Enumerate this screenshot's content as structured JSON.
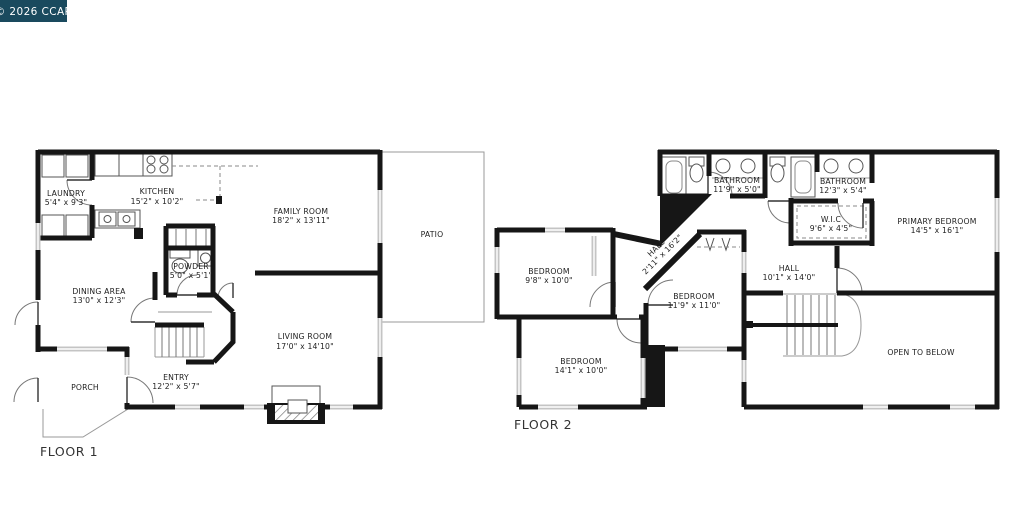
{
  "badge": {
    "label": "© 2026 CCAR"
  },
  "colors": {
    "badge_bg": "#1a4a5e",
    "wall": "#161616",
    "window": "#c4c4c4"
  },
  "floor1": {
    "label": "FLOOR 1",
    "rooms": {
      "laundry": {
        "name": "LAUNDRY",
        "dims": "5'4\" x 9'3\""
      },
      "kitchen": {
        "name": "KITCHEN",
        "dims": "15'2\" x 10'2\""
      },
      "family": {
        "name": "FAMILY ROOM",
        "dims": "18'2\" x 13'11\""
      },
      "patio": {
        "name": "PATIO"
      },
      "powder": {
        "name": "POWDER",
        "dims": "5'0\" x 5'1\""
      },
      "dining": {
        "name": "DINING AREA",
        "dims": "13'0\" x 12'3\""
      },
      "living": {
        "name": "LIVING ROOM",
        "dims": "17'0\" x 14'10\""
      },
      "entry": {
        "name": "ENTRY",
        "dims": "12'2\" x 5'7\""
      },
      "porch": {
        "name": "PORCH"
      }
    }
  },
  "floor2": {
    "label": "FLOOR 2",
    "rooms": {
      "bathroom1": {
        "name": "BATHROOM",
        "dims": "11'9\" x 5'0\""
      },
      "bathroom2": {
        "name": "BATHROOM",
        "dims": "12'3\" x 5'4\""
      },
      "wic": {
        "name": "W.I.C",
        "dims": "9'6\" x 4'5\""
      },
      "primary": {
        "name": "PRIMARY BEDROOM",
        "dims": "14'5\" x 16'1\""
      },
      "bedroom1": {
        "name": "BEDROOM",
        "dims": "9'8\" x 10'0\""
      },
      "hall_diag": {
        "name": "HALL",
        "dims": "2'11\" x 16'2\""
      },
      "bedroom2": {
        "name": "BEDROOM",
        "dims": "11'9\" x 11'0\""
      },
      "hall": {
        "name": "HALL",
        "dims": "10'1\" x 14'0\""
      },
      "bedroom3": {
        "name": "BEDROOM",
        "dims": "14'1\" x 10'0\""
      },
      "open_below": {
        "name": "OPEN TO BELOW"
      }
    }
  }
}
